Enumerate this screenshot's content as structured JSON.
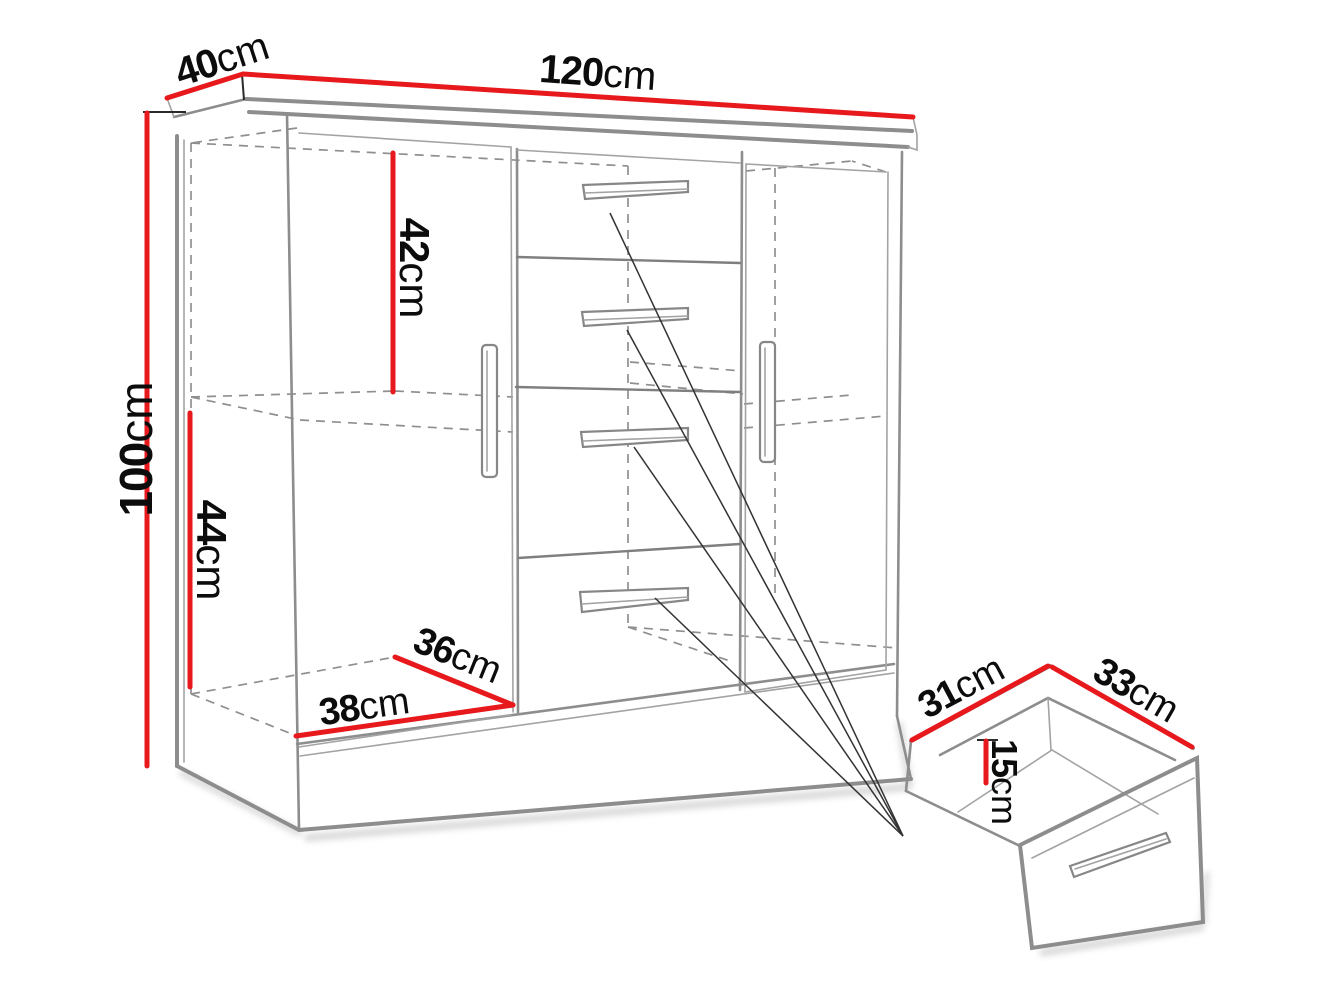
{
  "diagram": {
    "type": "furniture-dimension-drawing",
    "background": "#ffffff",
    "dimension_line_color": "#e7191d",
    "outline_color": "#8d8d8d",
    "label_color": "#0c0c0c",
    "cabinet": {
      "width": {
        "value": "120",
        "unit": "cm"
      },
      "depth": {
        "value": "40",
        "unit": "cm"
      },
      "height": {
        "value": "100",
        "unit": "cm"
      },
      "upper_compartment_height": {
        "value": "42",
        "unit": "cm"
      },
      "lower_compartment_height": {
        "value": "44",
        "unit": "cm"
      },
      "interior_depth": {
        "value": "36",
        "unit": "cm"
      },
      "interior_width": {
        "value": "38",
        "unit": "cm"
      }
    },
    "drawer_detail": {
      "depth": {
        "value": "31",
        "unit": "cm"
      },
      "width": {
        "value": "33",
        "unit": "cm"
      },
      "height": {
        "value": "15",
        "unit": "cm"
      }
    }
  }
}
